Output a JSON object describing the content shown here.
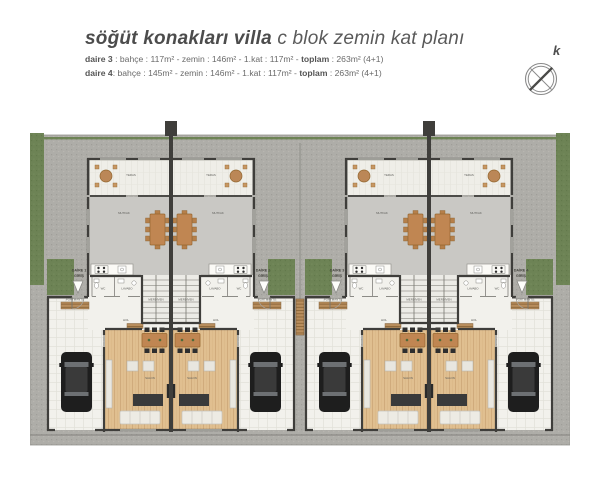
{
  "header": {
    "title_bold": "söğüt konakları villa",
    "title_rest": " c blok zemin kat planı",
    "info_lines": [
      {
        "name": "daire 3",
        "mid": " : bahçe : 117m² - zemin : 146m² - 1.kat : 117m² - ",
        "toplam": "toplam",
        "end": " : 263m² (4+1)"
      },
      {
        "name": "daire 4",
        "mid": ": bahçe : 145m² - zemin : 146m² - 1.kat : 117m² - ",
        "toplam": "toplam",
        "end": " : 263m² (4+1)"
      }
    ],
    "compass_letter": "k"
  },
  "plan": {
    "room_labels": {
      "teras": "TERAS",
      "mutfak": "MUTFAK",
      "salon": "SALON",
      "wc": "WC",
      "lavabo": "LAVABO",
      "merdiven": "MERDİVEN",
      "portmanto": "PORTMANTO",
      "hol": "HOL"
    },
    "units": [
      {
        "id": "daire-1",
        "entrance_line1": "DAİRE 1",
        "entrance_line2": "GİRİŞ"
      },
      {
        "id": "daire-2",
        "entrance_line1": "DAİRE 2",
        "entrance_line2": "GİRİŞ"
      },
      {
        "id": "daire-3",
        "entrance_line1": "DAİRE 3",
        "entrance_line2": "GİRİŞ"
      },
      {
        "id": "daire-4",
        "entrance_line1": "DAİRE 4",
        "entrance_line2": "GİRİŞ"
      }
    ],
    "colors": {
      "grass": "#6d8355",
      "pavement": "#aeada8",
      "terrace_floor": "#efeee8",
      "kitchen_floor": "#c9c8c4",
      "wood_floor": "#e0bf90",
      "garage_floor": "#f2f1ec",
      "wall": "#3f3e3b",
      "furniture_dark": "#3a3a3a",
      "furniture_light": "#edebe4",
      "wood_furniture": "#c08652",
      "car": "#1e1e1e",
      "title_text": "#4c4c4c"
    }
  }
}
